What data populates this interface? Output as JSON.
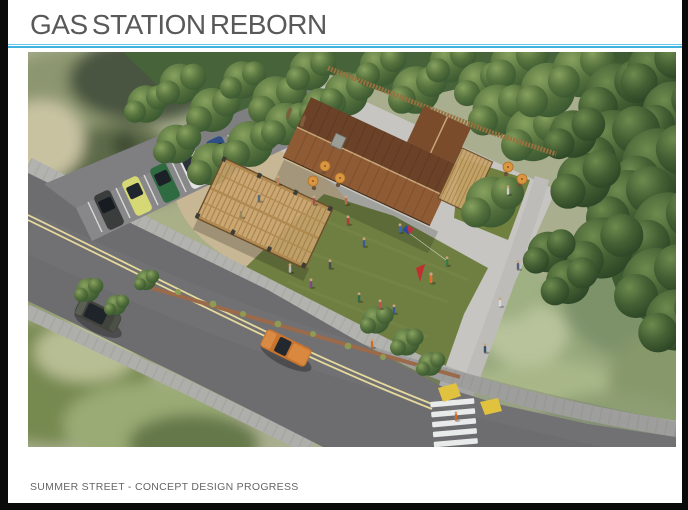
{
  "slide": {
    "title": "GAS STATION REBORN",
    "footer": "SUMMER STREET - CONCEPT DESIGN PROGRESS"
  },
  "style": {
    "accent_line_color": "#3fb3de",
    "title_color": "#595959",
    "footer_color": "#666666",
    "frame_color": "#0a0a0a"
  },
  "rendering": {
    "description": "Aerial 3D concept rendering of a former gas station site reborn as a community green: gabled brown-roof pavilion building with patio umbrellas, wooden trellis canopy over the old pump island, central lawn with people and a kite flyer, angled parking with five cars, tree-lined edges, curving street with double yellow lines, two passing cars, and a striped crosswalk with yellow curb ramps."
  }
}
